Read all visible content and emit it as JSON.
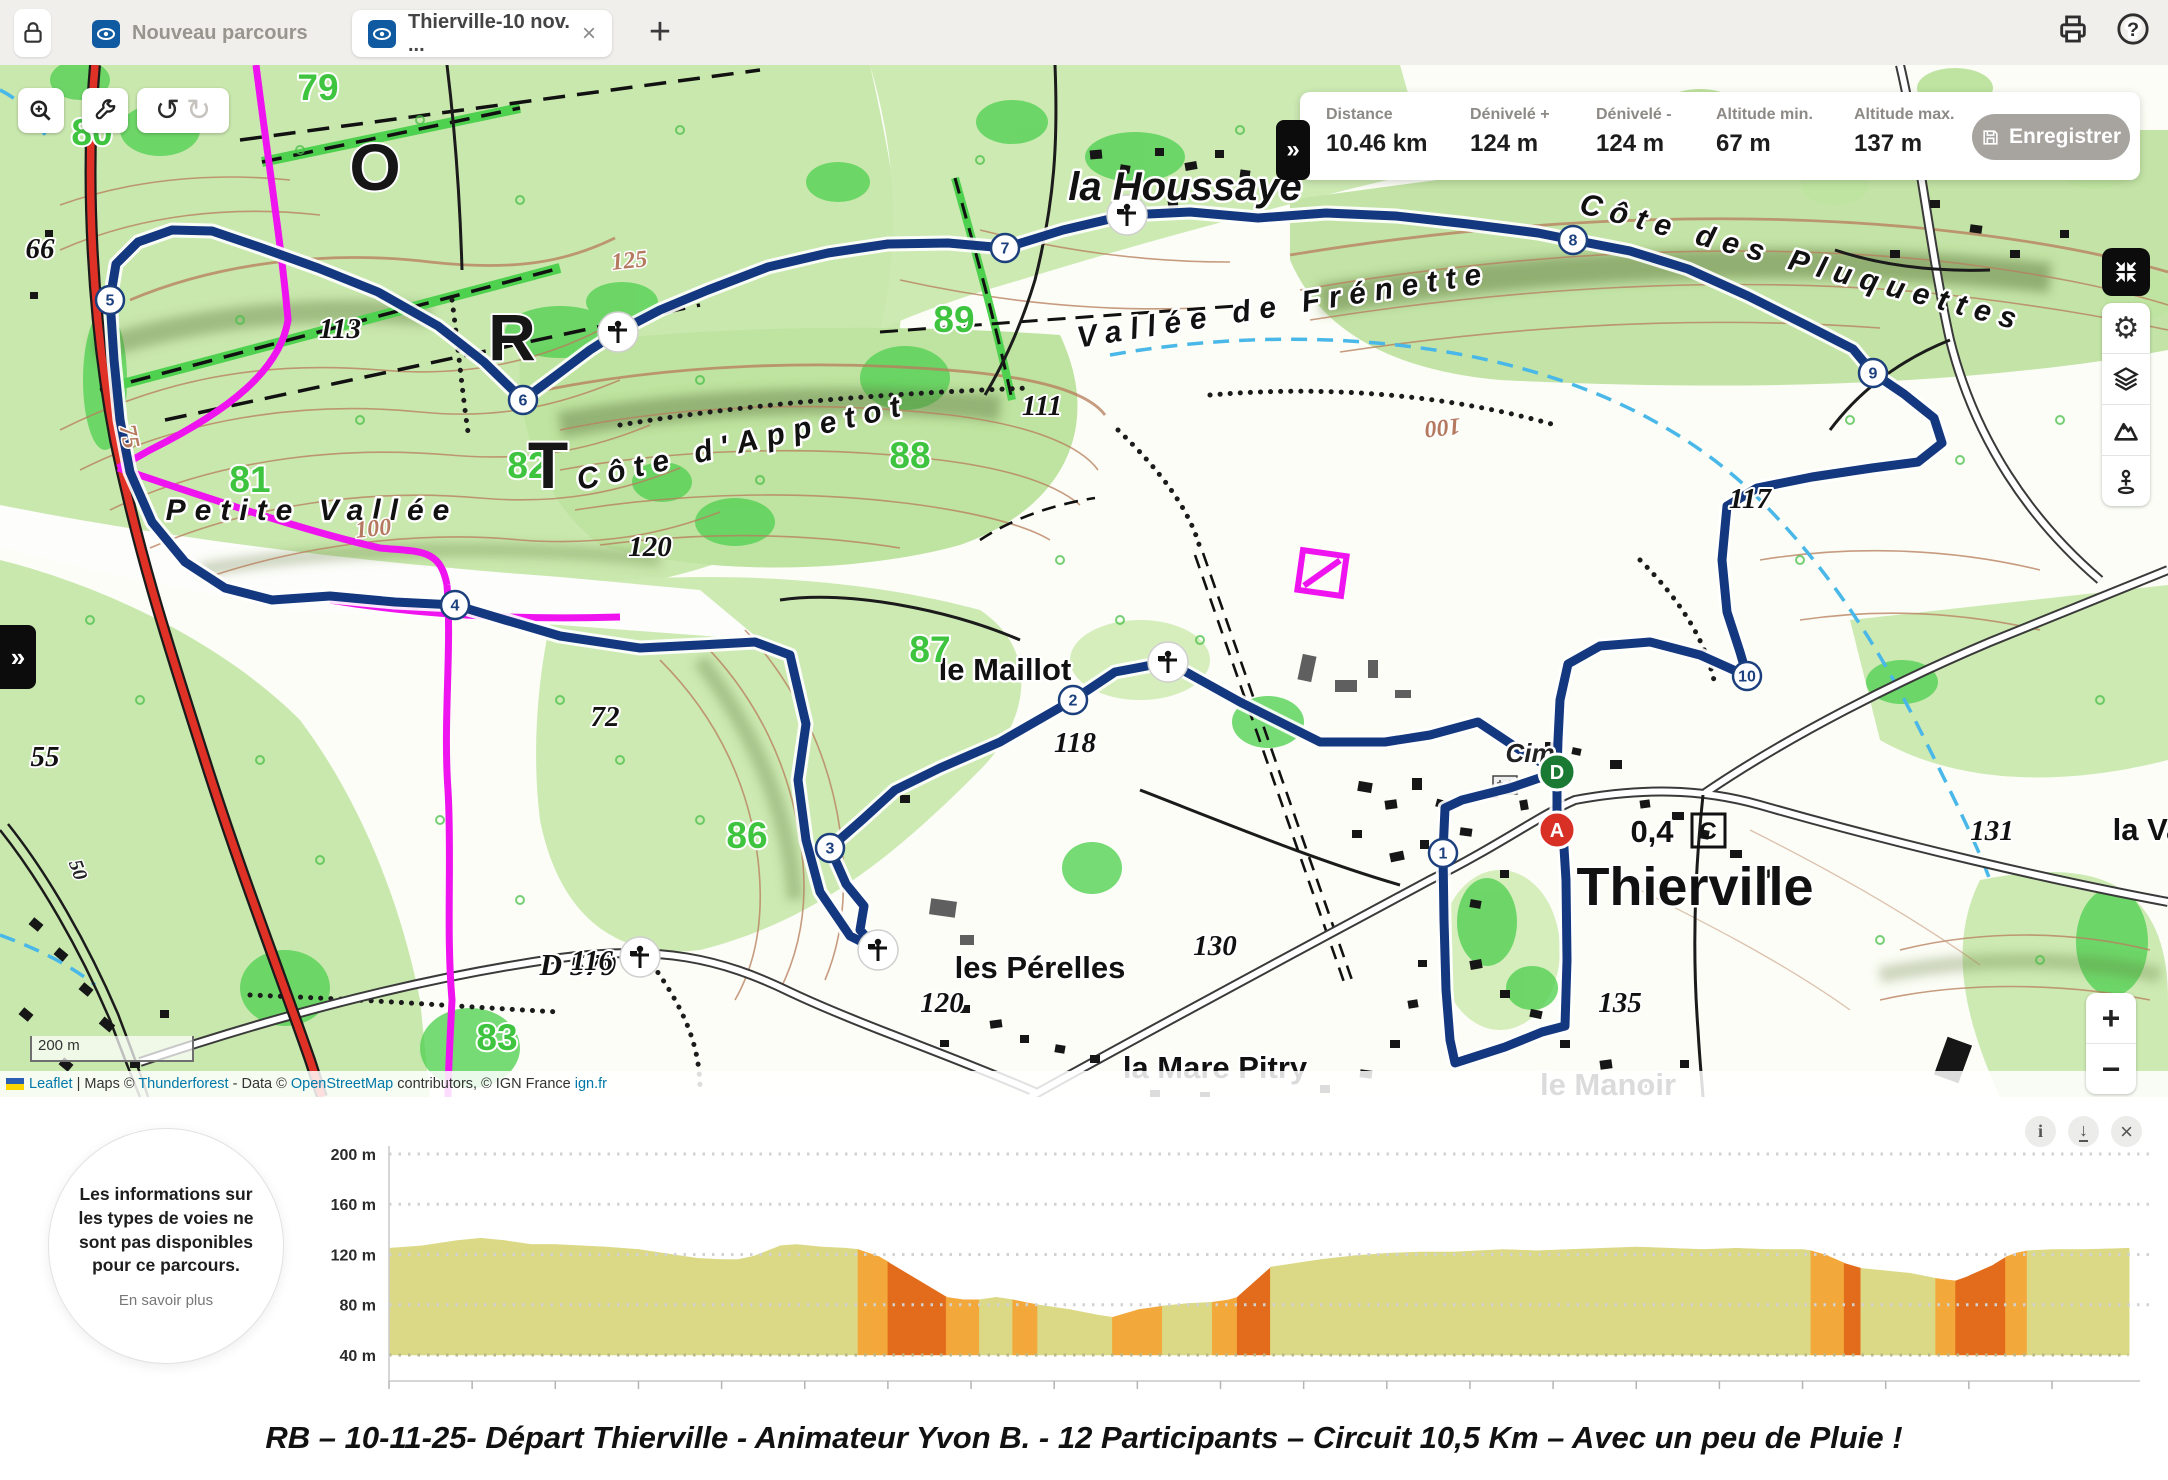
{
  "topbar": {
    "tabs": [
      {
        "label": "Nouveau parcours",
        "active": false
      },
      {
        "label": "Thierville-10 nov. ...",
        "active": true,
        "close": "×"
      }
    ],
    "new_tab_label": "+"
  },
  "statsbar": {
    "toggle": "»",
    "items": [
      {
        "label": "Distance",
        "value": "10.46 km"
      },
      {
        "label": "Dénivelé +",
        "value": "124 m"
      },
      {
        "label": "Dénivelé -",
        "value": "124 m"
      },
      {
        "label": "Altitude min.",
        "value": "67 m"
      },
      {
        "label": "Altitude max.",
        "value": "137 m"
      }
    ],
    "save_label": "Enregistrer"
  },
  "map": {
    "panel_toggle": "»",
    "scale_label": "200 m",
    "zoom_in": "+",
    "zoom_out": "−",
    "start_marker": "D",
    "end_marker": "A",
    "boxed_symbol": "C",
    "attribution": [
      {
        "t": "Leaflet",
        "link": true
      },
      {
        "t": " | Maps © ",
        "link": false
      },
      {
        "t": "Thunderforest",
        "link": true
      },
      {
        "t": " - Data © ",
        "link": false
      },
      {
        "t": "OpenStreetMap",
        "link": true
      },
      {
        "t": " contributors, © IGN France ",
        "link": false
      },
      {
        "t": "ign.fr",
        "link": true
      }
    ],
    "waypoints": [
      {
        "n": "1",
        "x": 1443,
        "y": 853
      },
      {
        "n": "2",
        "x": 1073,
        "y": 700
      },
      {
        "n": "3",
        "x": 830,
        "y": 848
      },
      {
        "n": "4",
        "x": 455,
        "y": 605
      },
      {
        "n": "5",
        "x": 110,
        "y": 300
      },
      {
        "n": "6",
        "x": 523,
        "y": 400
      },
      {
        "n": "7",
        "x": 1005,
        "y": 248
      },
      {
        "n": "8",
        "x": 1573,
        "y": 240
      },
      {
        "n": "9",
        "x": 1873,
        "y": 373
      },
      {
        "n": "10",
        "x": 1747,
        "y": 676
      }
    ],
    "poi": [
      {
        "x": 618,
        "y": 332
      },
      {
        "x": 1127,
        "y": 215
      },
      {
        "x": 1168,
        "y": 662
      },
      {
        "x": 878,
        "y": 950
      },
      {
        "x": 640,
        "y": 957
      }
    ],
    "labels": [
      {
        "t": "la Houssaye",
        "x": 1185,
        "y": 200,
        "c": "pl1"
      },
      {
        "t": "Thierville",
        "x": 1695,
        "y": 905,
        "c": "pl0"
      },
      {
        "t": "le Maillot",
        "x": 1005,
        "y": 680,
        "c": "pl3"
      },
      {
        "t": "les Pérelles",
        "x": 1040,
        "y": 978,
        "c": "pl3"
      },
      {
        "t": "la Mare Pitry",
        "x": 1215,
        "y": 1078,
        "c": "pl3"
      },
      {
        "t": "le Manoir",
        "x": 1608,
        "y": 1095,
        "c": "pl3"
      },
      {
        "t": "la Va",
        "x": 2148,
        "y": 840,
        "c": "pl3"
      },
      {
        "t": "Petite Vallée",
        "x": 312,
        "y": 520,
        "c": "pl2"
      },
      {
        "t": "Côte d'Appetot",
        "x": 745,
        "y": 452,
        "c": "pl2",
        "r": -13
      },
      {
        "t": "Vallée de Frénette",
        "x": 1285,
        "y": 315,
        "c": "pl2",
        "r": -9
      },
      {
        "t": "Côte des Pluquettes",
        "x": 1800,
        "y": 272,
        "c": "pl2",
        "r": 15
      },
      {
        "t": "Cim",
        "x": 1530,
        "y": 762,
        "c": "pl4"
      },
      {
        "t": "D 579",
        "x": 578,
        "y": 975,
        "c": "pl3i"
      },
      {
        "t": "0,4",
        "x": 1652,
        "y": 842,
        "c": "pl3"
      },
      {
        "t": "79",
        "x": 318,
        "y": 100,
        "c": "gn"
      },
      {
        "t": "80",
        "x": 92,
        "y": 145,
        "c": "gn"
      },
      {
        "t": "81",
        "x": 250,
        "y": 492,
        "c": "gn"
      },
      {
        "t": "82",
        "x": 528,
        "y": 478,
        "c": "gn"
      },
      {
        "t": "83",
        "x": 497,
        "y": 1050,
        "c": "gn"
      },
      {
        "t": "86",
        "x": 747,
        "y": 848,
        "c": "gn"
      },
      {
        "t": "87",
        "x": 930,
        "y": 662,
        "c": "gn"
      },
      {
        "t": "88",
        "x": 910,
        "y": 468,
        "c": "gn"
      },
      {
        "t": "89",
        "x": 954,
        "y": 332,
        "c": "gn"
      },
      {
        "t": "66",
        "x": 40,
        "y": 258,
        "c": "bn"
      },
      {
        "t": "113",
        "x": 340,
        "y": 338,
        "c": "bn"
      },
      {
        "t": "111",
        "x": 1042,
        "y": 415,
        "c": "bn"
      },
      {
        "t": "120",
        "x": 650,
        "y": 556,
        "c": "bn"
      },
      {
        "t": "72",
        "x": 605,
        "y": 726,
        "c": "bn"
      },
      {
        "t": "55",
        "x": 45,
        "y": 766,
        "c": "bn"
      },
      {
        "t": "116",
        "x": 592,
        "y": 970,
        "c": "bn"
      },
      {
        "t": "118",
        "x": 1075,
        "y": 752,
        "c": "bn"
      },
      {
        "t": "130",
        "x": 1215,
        "y": 955,
        "c": "bn"
      },
      {
        "t": "120",
        "x": 942,
        "y": 1012,
        "c": "bn"
      },
      {
        "t": "135",
        "x": 1620,
        "y": 1012,
        "c": "bn"
      },
      {
        "t": "131",
        "x": 1992,
        "y": 840,
        "c": "bn"
      },
      {
        "t": "117",
        "x": 1750,
        "y": 508,
        "c": "bn"
      },
      {
        "t": "100",
        "x": 374,
        "y": 536,
        "c": "cn",
        "r": -6
      },
      {
        "t": "100",
        "x": 1442,
        "y": 420,
        "c": "cn",
        "r": 174
      },
      {
        "t": "125",
        "x": 630,
        "y": 268,
        "c": "cn",
        "r": -6
      },
      {
        "t": "75",
        "x": 122,
        "y": 438,
        "c": "cn",
        "r": 78
      },
      {
        "t": "50",
        "x": 72,
        "y": 872,
        "c": "bn2",
        "r": 70
      },
      {
        "t": "O",
        "x": 375,
        "y": 190,
        "c": "big"
      },
      {
        "t": "R",
        "x": 512,
        "y": 360,
        "c": "big"
      },
      {
        "t": "T",
        "x": 548,
        "y": 488,
        "c": "big"
      }
    ]
  },
  "chart": {
    "tooltip": {
      "text": "Les informations sur les types de voies ne sont pas disponibles pour ce parcours.",
      "link": "En savoir plus"
    },
    "icons": {
      "info": "i",
      "download": "↓",
      "close": "×"
    }
  },
  "chart_data": {
    "type": "area",
    "title": "Profil altimétrique du parcours",
    "xlabel": "distance",
    "ylabel": "altitude",
    "xlim": [
      0,
      10.46
    ],
    "ylim": [
      40,
      200
    ],
    "grid": true,
    "y_ticks": [
      {
        "m": 200,
        "label": "200 m"
      },
      {
        "m": 160,
        "label": "160 m"
      },
      {
        "m": 120,
        "label": "120 m"
      },
      {
        "m": 80,
        "label": "80 m"
      },
      {
        "m": 40,
        "label": "40 m"
      }
    ],
    "x_ticks": [
      {
        "km": 0,
        "label": "0 m"
      },
      {
        "km": 0.5,
        "label": "500 m"
      },
      {
        "km": 1,
        "label": "1 km"
      },
      {
        "km": 1.5,
        "label": "1.5 km"
      },
      {
        "km": 2,
        "label": "2 km"
      },
      {
        "km": 2.5,
        "label": "2.5 km"
      },
      {
        "km": 3,
        "label": "3 km"
      },
      {
        "km": 3.5,
        "label": "3.5 km"
      },
      {
        "km": 4,
        "label": "4 km"
      },
      {
        "km": 4.5,
        "label": "4.5 km"
      },
      {
        "km": 5,
        "label": "5 km"
      },
      {
        "km": 5.5,
        "label": "5.5 km"
      },
      {
        "km": 6,
        "label": "6 km"
      },
      {
        "km": 6.5,
        "label": "6.5 km"
      },
      {
        "km": 7,
        "label": "7 km"
      },
      {
        "km": 7.5,
        "label": "7.5 km"
      },
      {
        "km": 8,
        "label": "8 km"
      },
      {
        "km": 8.5,
        "label": "8.5 km"
      },
      {
        "km": 9,
        "label": "9 km"
      },
      {
        "km": 9.5,
        "label": "9.5 km"
      },
      {
        "km": 10,
        "label": "10 km"
      }
    ],
    "profile": [
      [
        0,
        125
      ],
      [
        0.2,
        127
      ],
      [
        0.4,
        131
      ],
      [
        0.55,
        133
      ],
      [
        0.7,
        131
      ],
      [
        0.85,
        128
      ],
      [
        1.0,
        128
      ],
      [
        1.15,
        127
      ],
      [
        1.3,
        126
      ],
      [
        1.5,
        124
      ],
      [
        1.7,
        120
      ],
      [
        1.85,
        117
      ],
      [
        2.0,
        116
      ],
      [
        2.1,
        116
      ],
      [
        2.2,
        119
      ],
      [
        2.35,
        127
      ],
      [
        2.45,
        128
      ],
      [
        2.6,
        126
      ],
      [
        2.75,
        125
      ],
      [
        2.82,
        124
      ],
      [
        2.95,
        118
      ],
      [
        3.0,
        114
      ],
      [
        3.35,
        86
      ],
      [
        3.45,
        84
      ],
      [
        3.55,
        84
      ],
      [
        3.65,
        86
      ],
      [
        3.75,
        84
      ],
      [
        3.82,
        82
      ],
      [
        3.9,
        80
      ],
      [
        4.1,
        76
      ],
      [
        4.25,
        72
      ],
      [
        4.35,
        70
      ],
      [
        4.5,
        76
      ],
      [
        4.65,
        79
      ],
      [
        4.8,
        81
      ],
      [
        4.95,
        82
      ],
      [
        5.05,
        84
      ],
      [
        5.1,
        86
      ],
      [
        5.3,
        110
      ],
      [
        5.45,
        113
      ],
      [
        5.6,
        116
      ],
      [
        5.8,
        119
      ],
      [
        6.0,
        121
      ],
      [
        6.2,
        122
      ],
      [
        6.4,
        122
      ],
      [
        6.55,
        123
      ],
      [
        6.7,
        124
      ],
      [
        6.9,
        123
      ],
      [
        7.1,
        124
      ],
      [
        7.3,
        125
      ],
      [
        7.5,
        126
      ],
      [
        7.7,
        125
      ],
      [
        7.9,
        124
      ],
      [
        8.1,
        125
      ],
      [
        8.3,
        124
      ],
      [
        8.5,
        124
      ],
      [
        8.55,
        123
      ],
      [
        8.65,
        119
      ],
      [
        8.75,
        113
      ],
      [
        8.85,
        109
      ],
      [
        9.0,
        107
      ],
      [
        9.15,
        105
      ],
      [
        9.3,
        101
      ],
      [
        9.35,
        100
      ],
      [
        9.42,
        99
      ],
      [
        9.5,
        103
      ],
      [
        9.65,
        112
      ],
      [
        9.72,
        118
      ],
      [
        9.78,
        121
      ],
      [
        9.85,
        123
      ],
      [
        10.0,
        124
      ],
      [
        10.2,
        124
      ],
      [
        10.46,
        125
      ]
    ],
    "slope_segments": [
      {
        "from": 0,
        "to": 2.82,
        "type": "flat"
      },
      {
        "from": 2.82,
        "to": 2.98,
        "type": "moderate"
      },
      {
        "from": 2.98,
        "to": 3.38,
        "type": "steep"
      },
      {
        "from": 3.38,
        "to": 3.5,
        "type": "moderate"
      },
      {
        "from": 3.5,
        "to": 3.74,
        "type": "flat"
      },
      {
        "from": 3.74,
        "to": 3.86,
        "type": "moderate"
      },
      {
        "from": 3.86,
        "to": 4.4,
        "type": "flat"
      },
      {
        "from": 4.4,
        "to": 4.6,
        "type": "moderate"
      },
      {
        "from": 4.6,
        "to": 4.98,
        "type": "flat"
      },
      {
        "from": 4.98,
        "to": 5.08,
        "type": "moderate"
      },
      {
        "from": 5.08,
        "to": 5.34,
        "type": "steep"
      },
      {
        "from": 5.34,
        "to": 8.56,
        "type": "flat"
      },
      {
        "from": 8.56,
        "to": 8.7,
        "type": "moderate"
      },
      {
        "from": 8.7,
        "to": 8.8,
        "type": "steep"
      },
      {
        "from": 8.8,
        "to": 9.32,
        "type": "flat"
      },
      {
        "from": 9.32,
        "to": 9.45,
        "type": "moderate"
      },
      {
        "from": 9.45,
        "to": 9.73,
        "type": "steep"
      },
      {
        "from": 9.73,
        "to": 9.82,
        "type": "moderate"
      },
      {
        "from": 9.82,
        "to": 10.46,
        "type": "flat"
      }
    ],
    "colors": {
      "flat": "#dbd985",
      "moderate": "#f3a83b",
      "steep": "#e26c1b"
    },
    "route_color": "#14387f",
    "start_color": "#1a7a33",
    "end_color": "#d93025"
  },
  "caption": {
    "text": "RB – 10-11-25- Départ Thierville - Animateur Yvon B. - 12 Participants – Circuit 10,5 Km – Avec un peu de Pluie !"
  }
}
